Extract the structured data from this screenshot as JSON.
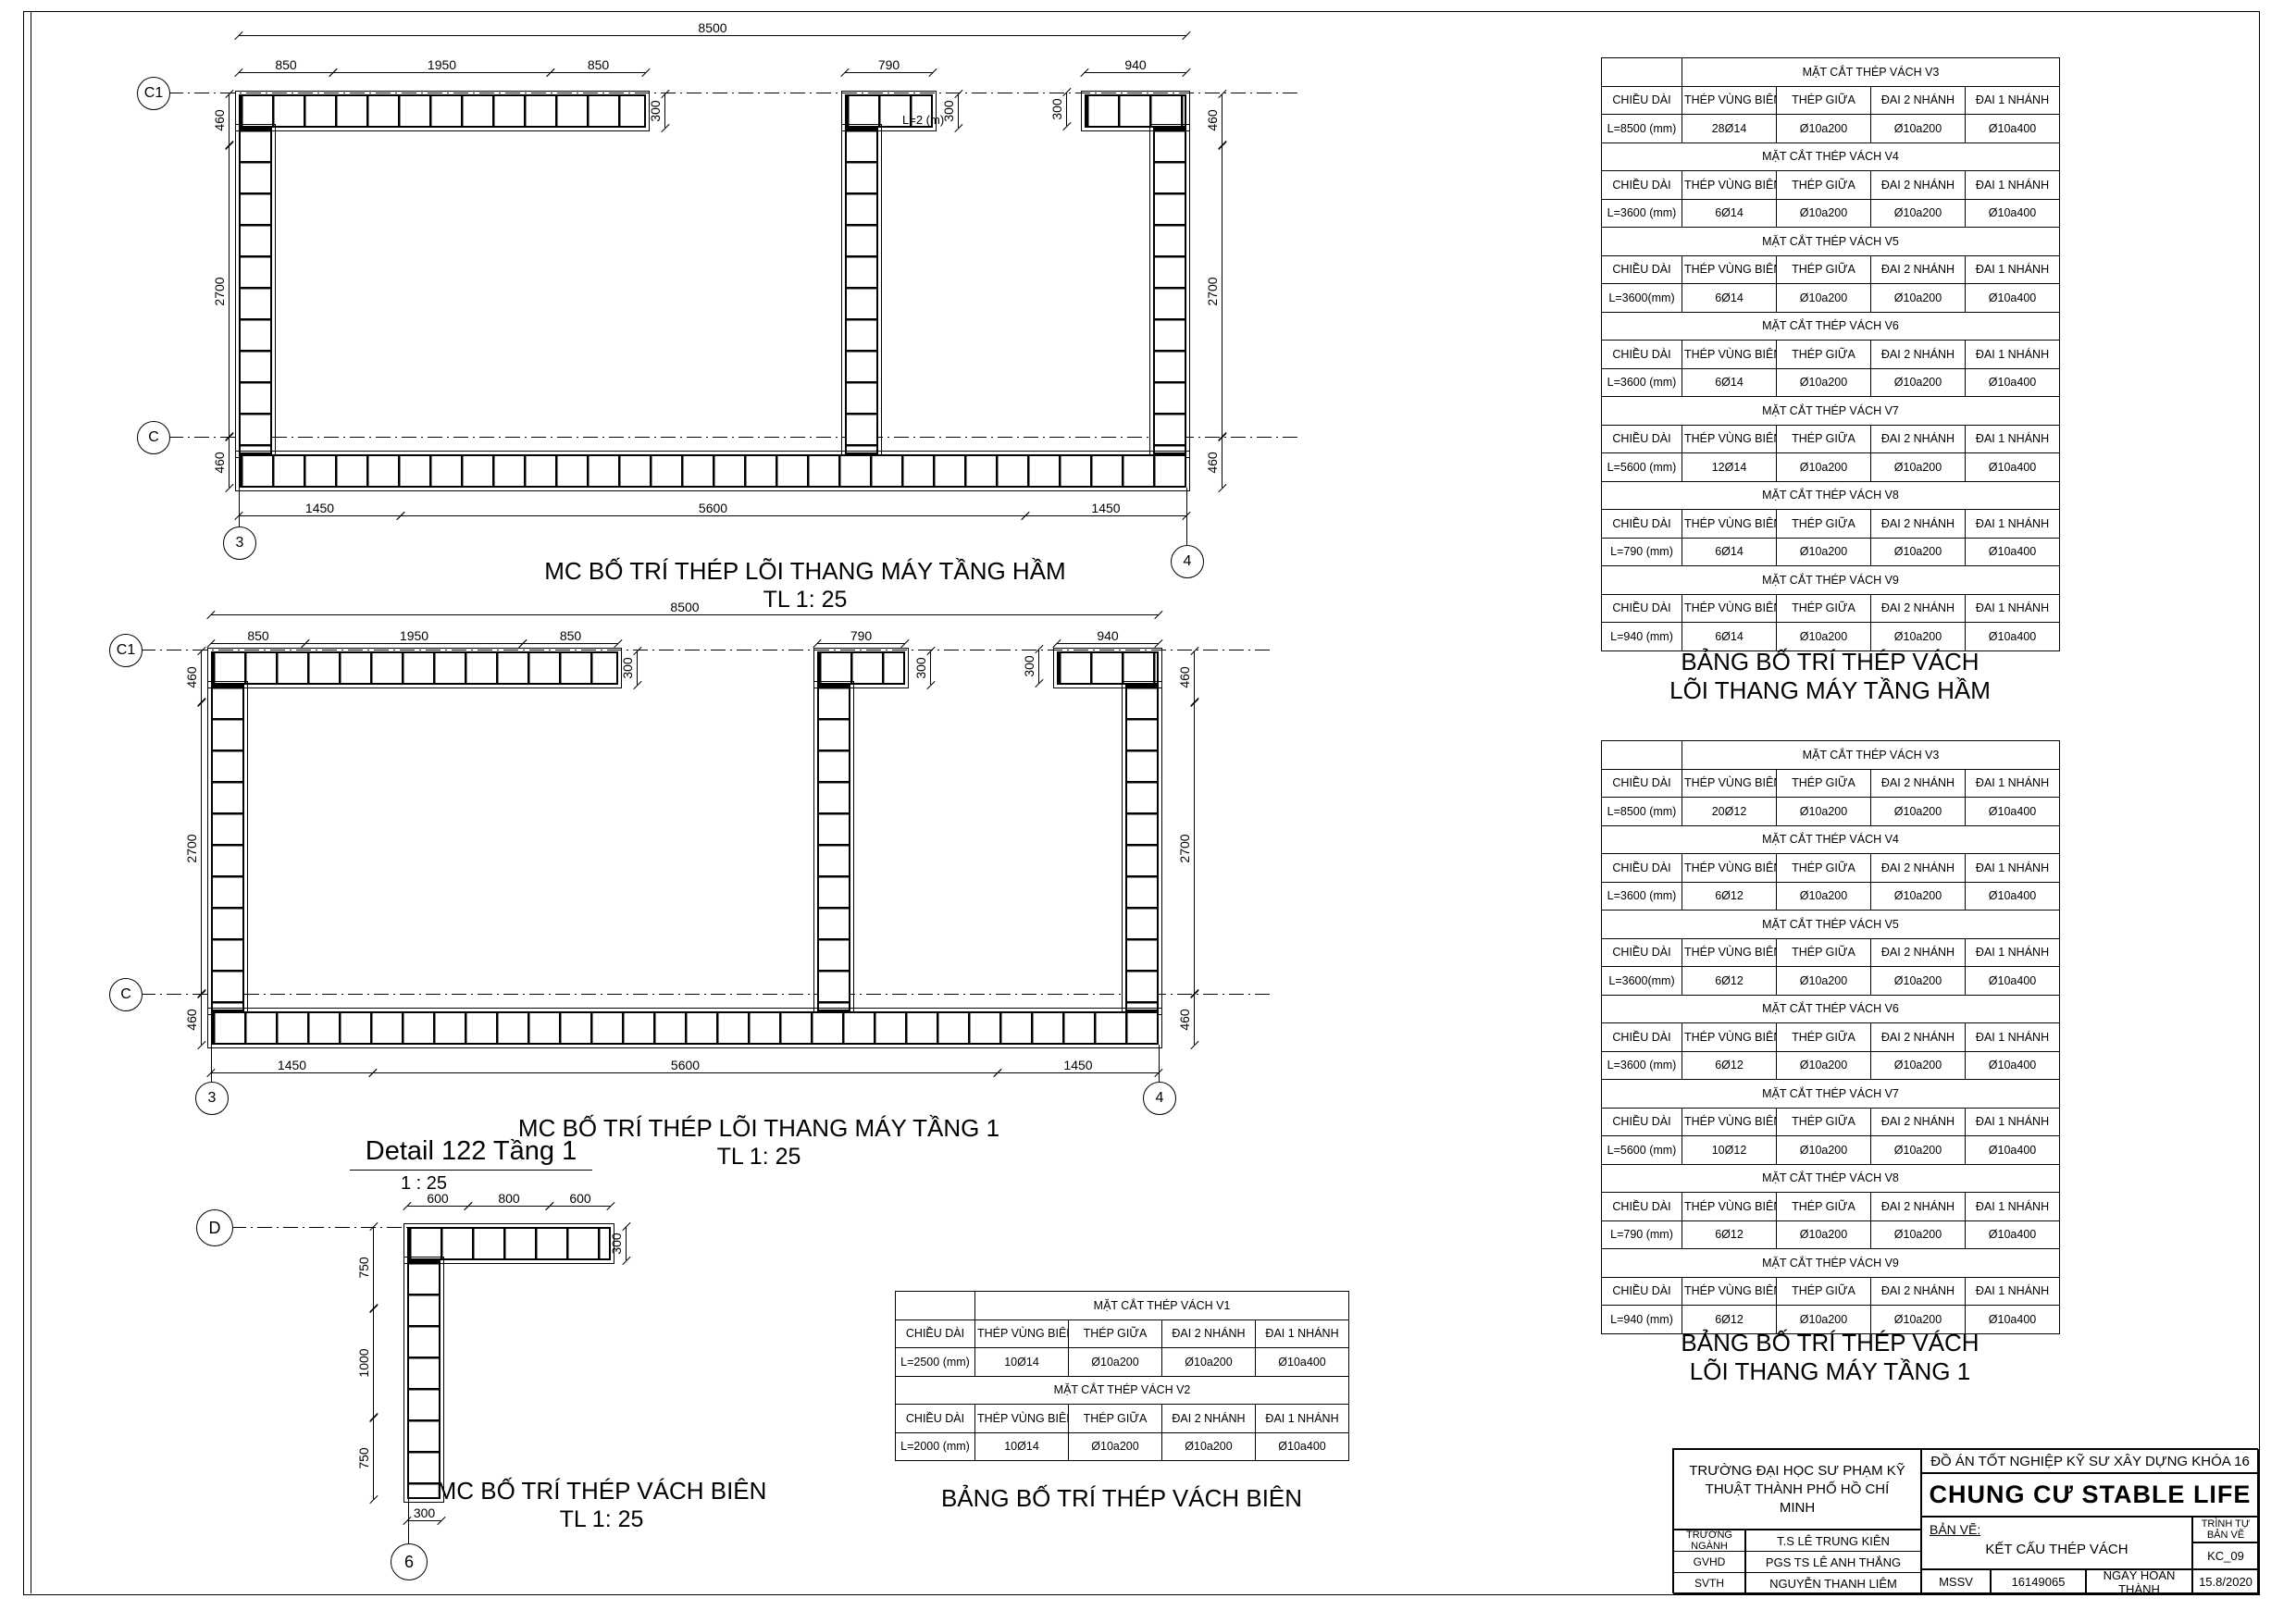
{
  "colors": {
    "ink": "#000000",
    "paper": "#ffffff"
  },
  "drawings": {
    "basement": {
      "caption": "MC BỐ TRÍ THÉP LÕI THANG MÁY TẦNG HẦM",
      "scale": "TL 1: 25",
      "grid": {
        "c1": "C1",
        "c": "C",
        "g3": "3",
        "g4": "4"
      },
      "dims": {
        "overall": "8500",
        "seg1": "850",
        "seg2": "1950",
        "seg3": "850",
        "mid_top": "790",
        "right_top": "940",
        "thick1": "300",
        "thick2": "300",
        "thick3": "300",
        "left_top": "460",
        "left_mid": "2700",
        "left_bot": "460",
        "right_side_top": "460",
        "right_side_mid": "2700",
        "right_side_bot": "460",
        "bot1": "1450",
        "bot2": "5600",
        "bot3": "1450",
        "note": "L=2 (m)"
      }
    },
    "floor1": {
      "caption": "MC BỐ TRÍ THÉP LÕI THANG MÁY TẦNG 1",
      "scale": "TL 1: 25",
      "grid": {
        "c1": "C1",
        "c": "C",
        "g3": "3",
        "g4": "4"
      },
      "dims": {
        "overall": "8500",
        "seg1": "850",
        "seg2": "1950",
        "seg3": "850",
        "mid_top": "790",
        "right_top": "940",
        "thick1": "300",
        "thick2": "300",
        "thick3": "300",
        "left_top": "460",
        "left_mid": "2700",
        "left_bot": "460",
        "right_side_top": "460",
        "right_side_mid": "2700",
        "right_side_bot": "460",
        "bot1": "1450",
        "bot2": "5600",
        "bot3": "1450"
      }
    },
    "detail": {
      "title": "Detail 122 Tầng 1",
      "title_scale": "1 : 25",
      "caption": "MC BỐ TRÍ THÉP VÁCH BIÊN",
      "scale": "TL 1: 25",
      "grid": {
        "d": "D",
        "g6": "6"
      },
      "dims": {
        "top1": "600",
        "top2": "800",
        "top3": "600",
        "thick_top": "300",
        "left1": "750",
        "left2": "1000",
        "left3": "750",
        "thick_bot": "300"
      }
    }
  },
  "tables": {
    "columns": [
      "CHIỀU DÀI",
      "THÉP VÙNG BIÊN",
      "THÉP GIỮA",
      "ĐAI 2 NHÁNH",
      "ĐAI 1 NHÁNH"
    ],
    "basement": {
      "title_line1": "BẢNG BỐ TRÍ THÉP VÁCH",
      "title_line2": "LÕI THANG MÁY TẦNG HẦM",
      "sections": [
        {
          "name": "MẶT CẮT THÉP VÁCH V3",
          "row": [
            "L=8500 (mm)",
            "28Ø14",
            "Ø10a200",
            "Ø10a200",
            "Ø10a400"
          ]
        },
        {
          "name": "MẶT CẮT THÉP VÁCH V4",
          "row": [
            "L=3600 (mm)",
            "6Ø14",
            "Ø10a200",
            "Ø10a200",
            "Ø10a400"
          ]
        },
        {
          "name": "MẶT CẮT THÉP VÁCH V5",
          "row": [
            "L=3600(mm)",
            "6Ø14",
            "Ø10a200",
            "Ø10a200",
            "Ø10a400"
          ]
        },
        {
          "name": "MẶT CẮT THÉP VÁCH V6",
          "row": [
            "L=3600 (mm)",
            "6Ø14",
            "Ø10a200",
            "Ø10a200",
            "Ø10a400"
          ]
        },
        {
          "name": "MẶT CẮT THÉP VÁCH V7",
          "row": [
            "L=5600 (mm)",
            "12Ø14",
            "Ø10a200",
            "Ø10a200",
            "Ø10a400"
          ]
        },
        {
          "name": "MẶT CẮT THÉP VÁCH V8",
          "row": [
            "L=790 (mm)",
            "6Ø14",
            "Ø10a200",
            "Ø10a200",
            "Ø10a400"
          ]
        },
        {
          "name": "MẶT CẮT THÉP VÁCH V9",
          "row": [
            "L=940 (mm)",
            "6Ø14",
            "Ø10a200",
            "Ø10a200",
            "Ø10a400"
          ]
        }
      ]
    },
    "floor1": {
      "title_line1": "BẢNG BỐ TRÍ THÉP VÁCH",
      "title_line2": "LÕI THANG MÁY TẦNG 1",
      "sections": [
        {
          "name": "MẶT CẮT THÉP VÁCH V3",
          "row": [
            "L=8500 (mm)",
            "20Ø12",
            "Ø10a200",
            "Ø10a200",
            "Ø10a400"
          ]
        },
        {
          "name": "MẶT CẮT THÉP VÁCH V4",
          "row": [
            "L=3600 (mm)",
            "6Ø12",
            "Ø10a200",
            "Ø10a200",
            "Ø10a400"
          ]
        },
        {
          "name": "MẶT CẮT THÉP VÁCH V5",
          "row": [
            "L=3600(mm)",
            "6Ø12",
            "Ø10a200",
            "Ø10a200",
            "Ø10a400"
          ]
        },
        {
          "name": "MẶT CẮT THÉP VÁCH V6",
          "row": [
            "L=3600 (mm)",
            "6Ø12",
            "Ø10a200",
            "Ø10a200",
            "Ø10a400"
          ]
        },
        {
          "name": "MẶT CẮT THÉP VÁCH V7",
          "row": [
            "L=5600 (mm)",
            "10Ø12",
            "Ø10a200",
            "Ø10a200",
            "Ø10a400"
          ]
        },
        {
          "name": "MẶT CẮT THÉP VÁCH V8",
          "row": [
            "L=790 (mm)",
            "6Ø12",
            "Ø10a200",
            "Ø10a200",
            "Ø10a400"
          ]
        },
        {
          "name": "MẶT CẮT THÉP VÁCH V9",
          "row": [
            "L=940 (mm)",
            "6Ø12",
            "Ø10a200",
            "Ø10a200",
            "Ø10a400"
          ]
        }
      ]
    },
    "edge": {
      "title": "BẢNG BỐ TRÍ THÉP VÁCH BIÊN",
      "sections": [
        {
          "name": "MẶT CẮT THÉP VÁCH V1",
          "row": [
            "L=2500 (mm)",
            "10Ø14",
            "Ø10a200",
            "Ø10a200",
            "Ø10a400"
          ]
        },
        {
          "name": "MẶT CẮT THÉP VÁCH V2",
          "row": [
            "L=2000 (mm)",
            "10Ø14",
            "Ø10a200",
            "Ø10a200",
            "Ø10a400"
          ]
        }
      ]
    }
  },
  "titleblock": {
    "school": "TRƯỜNG ĐẠI HỌC SƯ PHẠM KỸ THUẬT THÀNH PHỐ HỒ CHÍ MINH",
    "row1_label": "TRƯỞNG NGÀNH",
    "row1_value": "T.S LÊ TRUNG KIÊN",
    "row2_label": "GVHD",
    "row2_value": "PGS TS LÊ ANH THẮNG",
    "row3_label": "SVTH",
    "row3_value": "NGUYỄN THANH LIÊM",
    "project_type": "ĐỒ ÁN TỐT NGHIỆP KỸ SƯ XÂY DỰNG KHÓA 16",
    "project_name": "CHUNG CƯ STABLE LIFE",
    "drawing_label": "BẢN VẼ:",
    "drawing_name": "KẾT CẤU THÉP VÁCH",
    "seq_label": "TRÌNH TỰ BẢN VẼ",
    "seq_value": "KC_09",
    "mssv_label": "MSSV",
    "mssv_value": "16149065",
    "date_label": "NGÀY HOÀN THÀNH",
    "date_value": "15.8/2020"
  }
}
